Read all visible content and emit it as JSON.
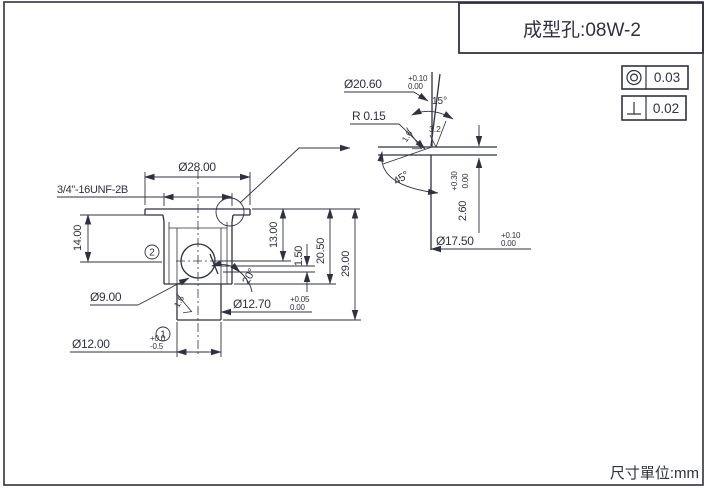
{
  "meta": {
    "ink_color": "#2f3140",
    "background": "#ffffff"
  },
  "title_block": {
    "title": "成型孔:08W-2"
  },
  "page": {
    "unit_label": "尺寸單位:mm"
  },
  "tolerance_table": {
    "rows": [
      {
        "symbol": "concentricity-icon",
        "value": "0.03"
      },
      {
        "symbol": "perpendicularity-icon",
        "value": "0.02"
      }
    ]
  },
  "main_view": {
    "flange_dia": "Ø28.00",
    "thread_spec": "3/4\"-16UNF-2B",
    "height_14": "14.00",
    "height_13": "13.00",
    "height_1_5": "1.50",
    "height_20_5": "20.50",
    "height_29": "29.00",
    "ball_dia": "Ø9.00",
    "stem_dia": "Ø12.70",
    "stem_dia_tol_upper": "+0.05",
    "stem_dia_tol_lower": "0.00",
    "end_dia": "Ø12.00",
    "end_dia_tol_upper": "+0.0",
    "end_dia_tol_lower": "-0.5",
    "seat_angle": "20°",
    "roughness": "1.6",
    "balloon_1": "1",
    "balloon_2": "2"
  },
  "detail_view": {
    "bore_dia": "Ø20.60",
    "bore_dia_tol_upper": "+0.10",
    "bore_dia_tol_lower": "0.00",
    "radius": "R 0.15",
    "taper_angle": "15°",
    "roughness_fine": "1.6",
    "roughness_coarse": "3.2",
    "chamfer_angle": "45°",
    "depth": "2.60",
    "depth_tol_upper": "+0.30",
    "depth_tol_lower": "0.00",
    "seat_dia": "Ø17.50",
    "seat_dia_tol_upper": "+0.10",
    "seat_dia_tol_lower": "0.00"
  }
}
